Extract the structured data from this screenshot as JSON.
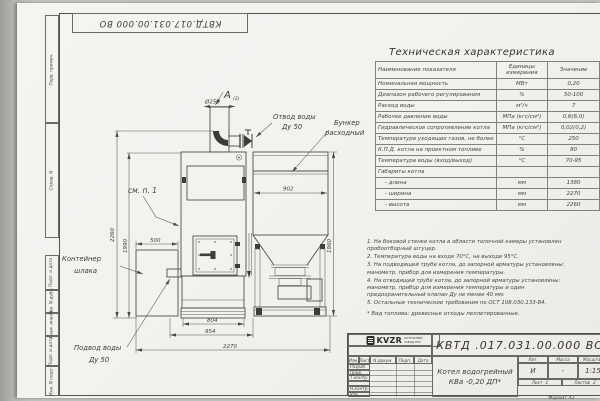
{
  "frame": {
    "top_doc": "КВТД.017.031.00.000  ВО",
    "left_labels": [
      "Перв. примен.",
      "Справ. N",
      "Подп. и дата",
      "Инв. N дубл.",
      "Взам. инв. N",
      "Подп. и дата",
      "Инв. N подл."
    ],
    "format": "Формат А3"
  },
  "tech_table": {
    "title": "Техническая характеристика",
    "headers": [
      "Наименование показателя",
      "Единицы измерения",
      "Значение"
    ],
    "rows": [
      [
        "Номинальная мощность",
        "МВт",
        "0,20"
      ],
      [
        "Диапазон рабочего регулирования",
        "%",
        "50-100"
      ],
      [
        "Расход воды",
        "м³/ч",
        "7"
      ],
      [
        "Рабочее давление воды",
        "МПа (кгс/см²)",
        "0,6(6,0)"
      ],
      [
        "Гидравлическое сопротивление котла",
        "МПа (кгс/см²)",
        "0,02(0,2)"
      ],
      [
        "Температура уходящих газов, не более",
        "°С",
        "250"
      ],
      [
        "К.П.Д. котла на проектном топливе",
        "%",
        "80"
      ],
      [
        "Температура воды (вход/выход)",
        "°С",
        "70-95"
      ],
      [
        "Габариты котла",
        "",
        ""
      ],
      [
        "- длина",
        "мм",
        "1380"
      ],
      [
        "- ширина",
        "мм",
        "2270"
      ],
      [
        "- высота",
        "мм",
        "2260"
      ]
    ]
  },
  "notes": [
    "1. На боковой стенке котла в области топочной камеры установлен пробоотборный штуцер.",
    "2. Температура воды на входе 70°С, на выходе 95°С.",
    "3. На подводящей трубе котла, до запорной арматуры установлены: манометр, прибор для измерения температуры.",
    "4. На отводящей трубе котла, до запорной арматуры установлены: манометр, прибор для измерения температуры и один предохранительный клапан Ду не менее 40 мм.",
    "5. Остальные технические требования по ОСТ 108.030.133-84."
  ],
  "footnote": "* Вид топлива: древесные отходы пеллетированные.",
  "drawing": {
    "view_letter": "А",
    "view_ref": "(2)",
    "labels": {
      "otvod_1": "Отвод воды",
      "otvod_2": "Ду 50",
      "bunker_1": "Бункер",
      "bunker_2": "расходный",
      "see_note": "см. п. 1",
      "container_1": "Контейнер",
      "container_2": "шлака",
      "podvod_1": "Подвод воды",
      "podvod_2": "Ду 50"
    },
    "dims": {
      "d250": "Ø250",
      "h2260": "2260",
      "h1990": "1990",
      "w500": "500",
      "w902": "902",
      "h1960": "1960",
      "w804": "804",
      "w954": "954",
      "w2270": "2270"
    }
  },
  "title_block": {
    "doc_number": "КВТД .017.031.00.000  ВО",
    "product_line_1": "Котел водогрейный",
    "product_line_2": "КВа -0,20  ДП*",
    "cols": [
      "Изм.",
      "Лист",
      "N докум.",
      "Подп.",
      "Дата"
    ],
    "sign_rows": [
      "Разраб.",
      "Пров.",
      "Т.контр.",
      "",
      "Н.контр.",
      "Утв."
    ],
    "lit_label": "Лит.",
    "mass_label": "Масса",
    "scale_label": "Масштаб",
    "lit": "И",
    "mass": "-",
    "scale": "1:15",
    "sheet_label": "Лист",
    "sheet": "1",
    "sheets_label": "Листов",
    "sheets": "2",
    "brand": "KVZR",
    "brand_line_1": "КОТЕЛЬНЫЙ",
    "brand_line_2": "ЗАВОД РЭП"
  }
}
